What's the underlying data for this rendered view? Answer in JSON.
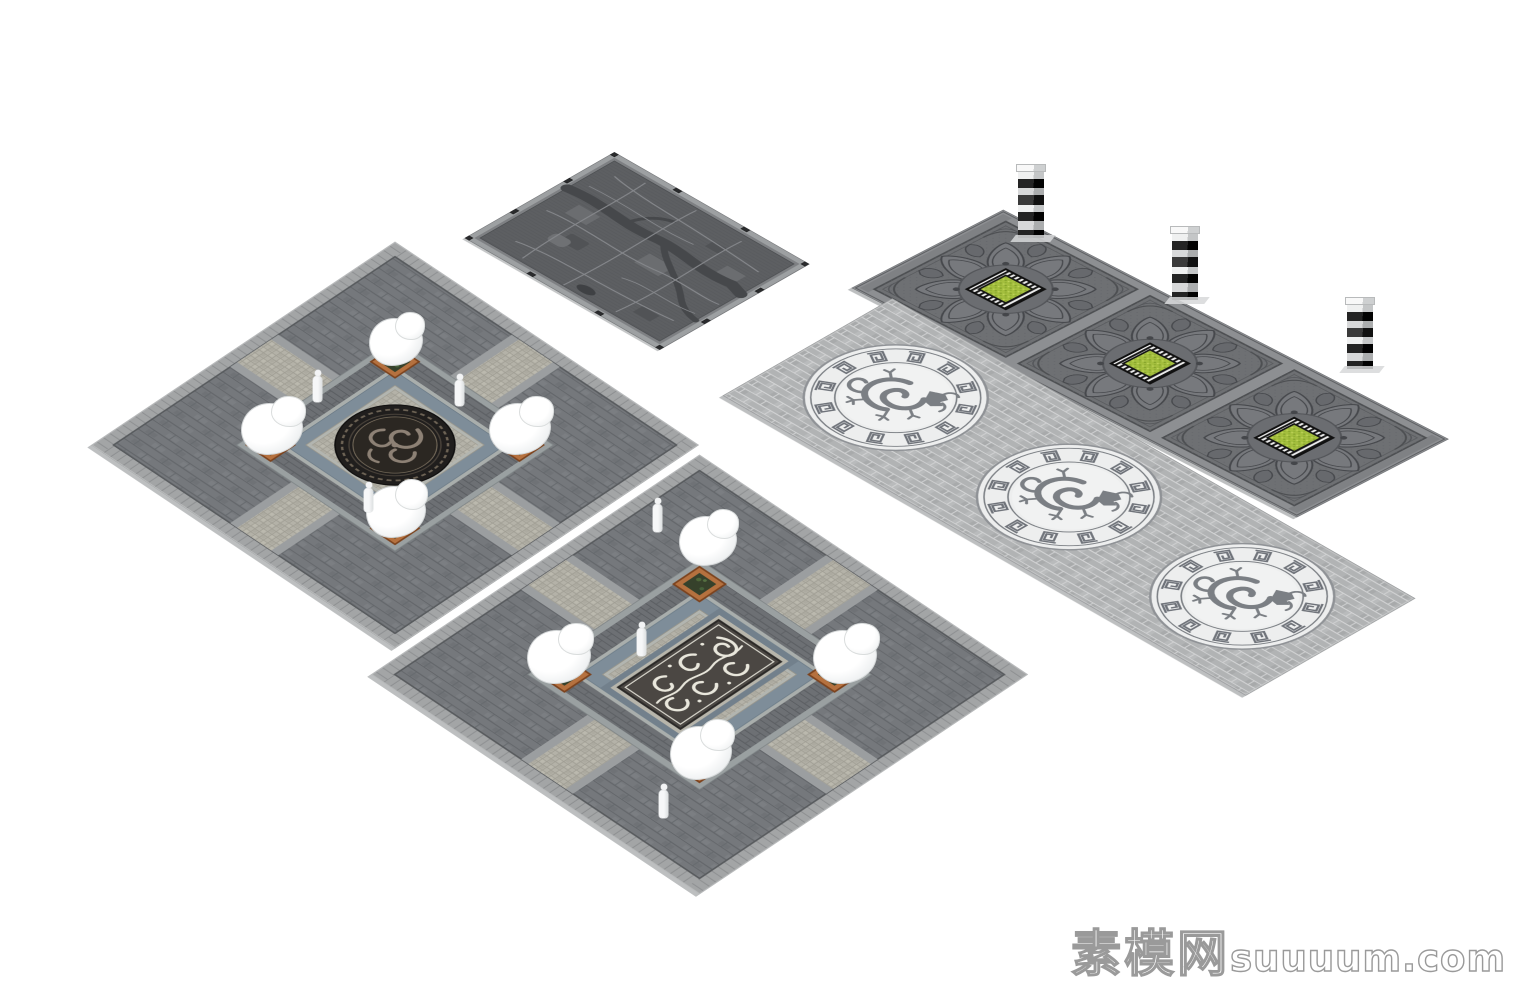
{
  "watermark": {
    "cjk": "素模网",
    "latin": "suuuum.com"
  },
  "palette": {
    "background": "#ffffff",
    "brick_dark": "#75787c",
    "brick_joint_dark": "#616468",
    "border_light": "#a3a5a6",
    "cobble_light": "#b4b2a8",
    "channel_blue": "#7e8d99",
    "curb_light": "#9aa0a1",
    "medallion_black": "#201e1d",
    "medallion_swirl": "#8d8175",
    "medallion2_field": "#4b4743",
    "medallion2_swirl": "#e9e7dc",
    "pedestal_orange": "#b5713f",
    "pedestal_plants": "#36412b",
    "rock_white": "#ffffff",
    "panel_gray": "#6e7073",
    "panel_relief": "#46484c",
    "planter_green": "#a4bf3e",
    "planter_stripe_dark": "#161616",
    "planter_stripe_light": "#ececec",
    "walkway_brick": "#b1b3b4",
    "walkway_joint": "#d6d7d8",
    "dragon_ring_white": "#edeeee",
    "meander_gray": "#6f737a",
    "dragon_gray": "#7b7f84",
    "column_black": "#111111",
    "column_white": "#eff0f0",
    "map_field": "#5d5f62",
    "map_frame": "#9da0a2",
    "map_river": "#46484b",
    "map_road": "#85878b",
    "watermark_outline": "#9a9a9a"
  },
  "scene": {
    "items": [
      {
        "name": "square-plaza-round-medallion",
        "count": 1
      },
      {
        "name": "square-plaza-rect-medallion",
        "count": 1
      },
      {
        "name": "carved-map-relief-panel",
        "count": 1
      },
      {
        "name": "lotus-relief-panel-with-planter",
        "count": 3
      },
      {
        "name": "striped-totem-column",
        "count": 3
      },
      {
        "name": "dragon-medallion-walkway",
        "count": 1
      },
      {
        "name": "dragon-medallion",
        "count": 3
      },
      {
        "name": "white-rock-on-planter-base",
        "count": 8
      },
      {
        "name": "human-figure",
        "count": 6
      }
    ]
  }
}
